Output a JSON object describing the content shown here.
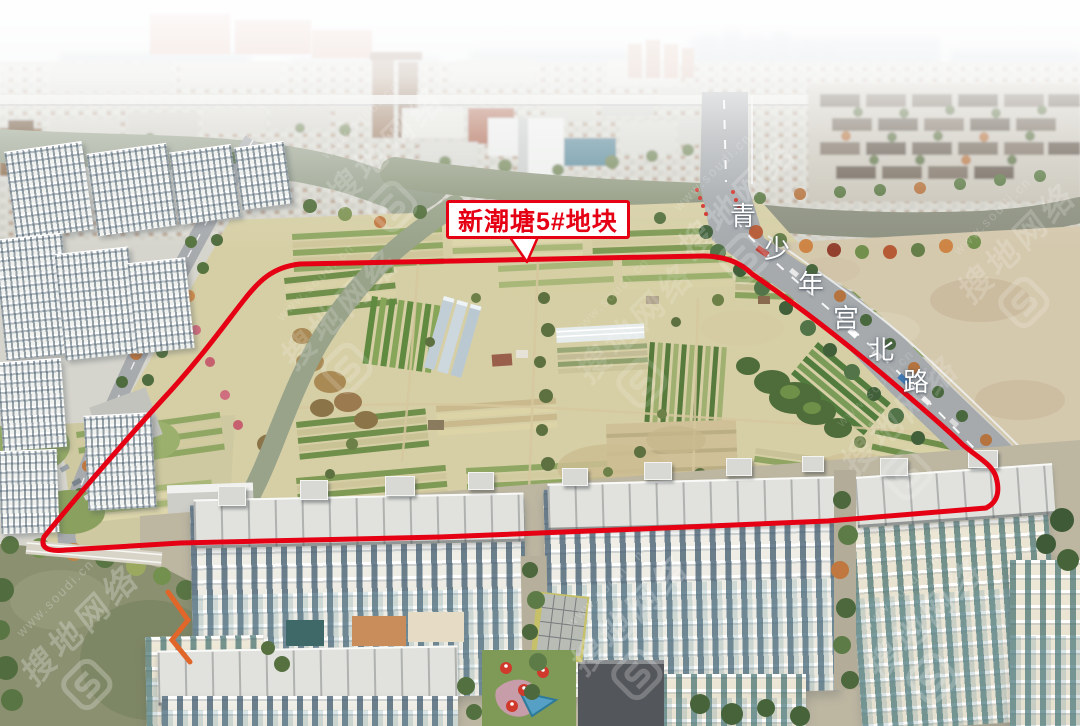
{
  "annotations": {
    "parcel_label": "新潮塘5#地块",
    "road_name": "青少年宫北路",
    "road_name_chars": [
      "青",
      "少",
      "年",
      "宫",
      "北",
      "路"
    ]
  },
  "watermark": {
    "brand": "搜地网络",
    "url": "www.soudi.cn"
  },
  "icons": {
    "watermark_logo": "soudi-s-logo"
  },
  "colors": {
    "boundary_red": "#e60014",
    "label_background": "#ffffff",
    "label_text": "#e60014",
    "road_text": "#ffffff",
    "watermark_white": "rgba(255,255,255,0.45)"
  }
}
